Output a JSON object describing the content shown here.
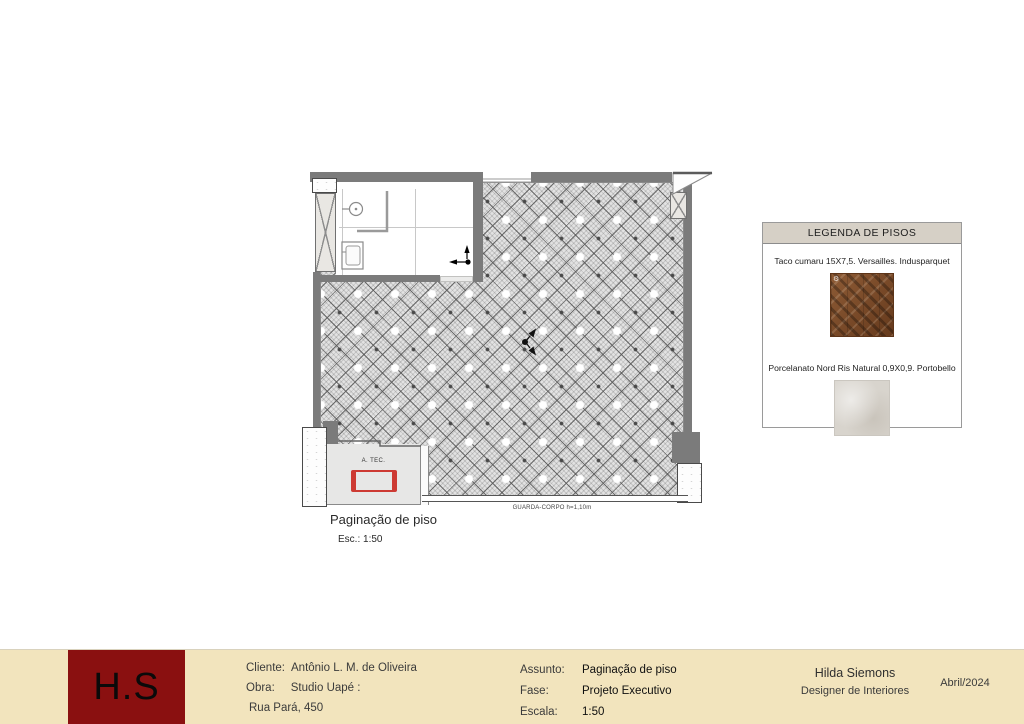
{
  "plan": {
    "title": "Paginação de piso",
    "scale_label": "Esc.: 1:50",
    "labels": {
      "a_tec": "A. TEC.",
      "guarda_corpo": "GUARDA-CORPO h=1,10m"
    }
  },
  "legend": {
    "title": "LEGENDA DE PISOS",
    "items": [
      {
        "label": "Taco cumaru 15X7,5. Versailles. Indusparquet",
        "swatch": "wood-parquet"
      },
      {
        "label": "Porcelanato Nord Ris Natural 0,9X0,9. Portobello",
        "swatch": "porcelain-tile"
      }
    ]
  },
  "title_block": {
    "logo_text": "H.S",
    "client_label": "Cliente:",
    "client": "Antônio L. M. de Oliveira",
    "work_label": "Obra:",
    "work": "Studio Uapé :",
    "address": "Rua Pará, 450",
    "subject_label": "Assunto:",
    "subject": "Paginação de piso",
    "phase_label": "Fase:",
    "phase": "Projeto Executivo",
    "scale_label": "Escala:",
    "scale": "1:50",
    "designer_name": "Hilda Siemons",
    "designer_title": "Designer de Interiores",
    "date": "Abril/2024"
  },
  "colors": {
    "wall_gray": "#7b7b7b",
    "titleblock_bg": "#f2e4bd",
    "logo_red": "#8a1010",
    "legend_header_bg": "#d6d0c6",
    "condenser_red": "#cd3a33"
  }
}
